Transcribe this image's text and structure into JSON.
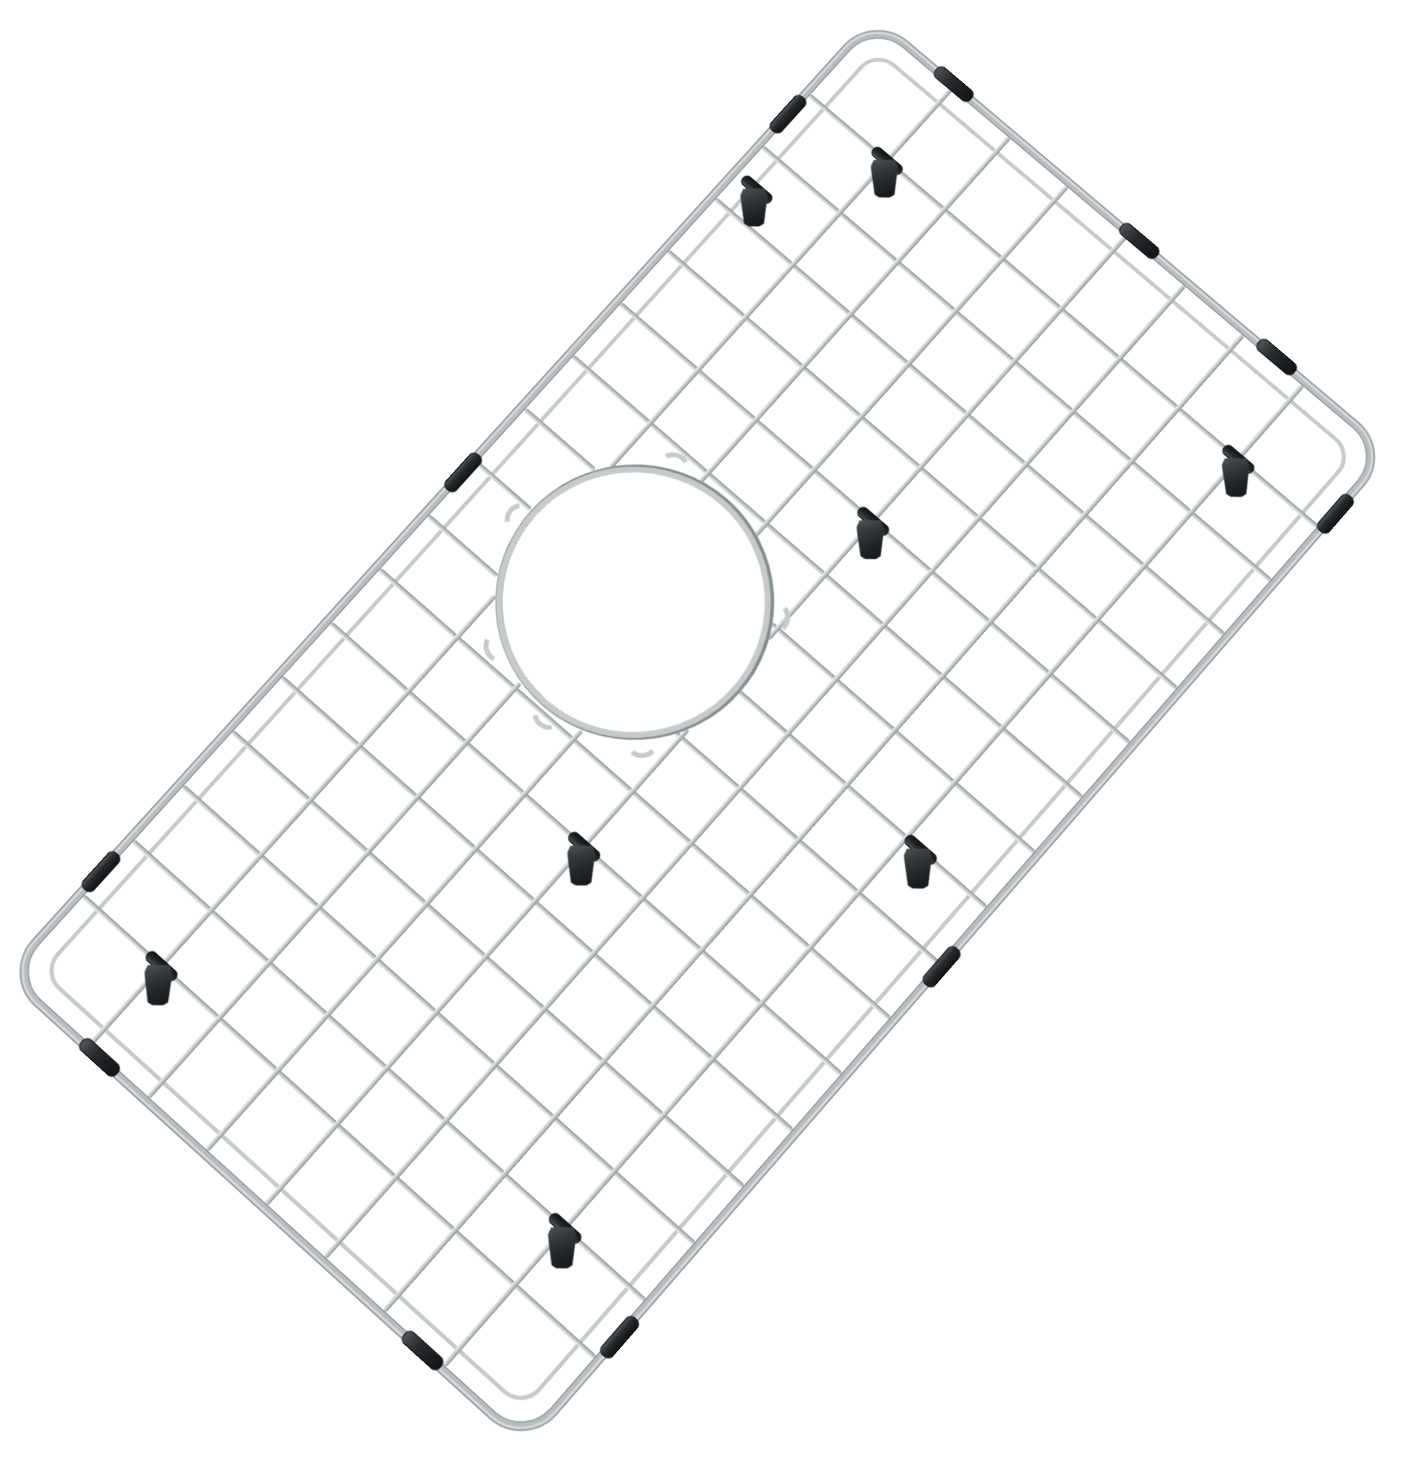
{
  "product": {
    "description": "stainless-steel-sink-bottom-grid-with-drain-hole",
    "background_color": "#ffffff"
  },
  "scene": {
    "canvas_w": 1405,
    "canvas_h": 1468,
    "plane_w": 1315,
    "plane_h": 695,
    "center_x": 704,
    "center_y": 710,
    "rotation_deg": -48.6,
    "tilt_deg": 7,
    "perspective_px": 3000
  },
  "colors": {
    "bg": "#ffffff",
    "wire_hi": "#f1f3f3",
    "wire_mid": "#c6cacb",
    "wire_dk": "#8e9597",
    "frame_hi": "#dfe3e4",
    "frame_mid": "#b7bdbf",
    "frame_dk": "#868d90",
    "rubber_hi": "#4d5357",
    "rubber_mid": "#26292d",
    "rubber_dk": "#121517"
  },
  "frame": {
    "thickness": 7,
    "corner_radius": 46
  },
  "inner_frame": {
    "inset": 26,
    "thickness": 4,
    "corner_radius": 26
  },
  "wires": {
    "thickness": 5,
    "span_pad": 8,
    "cross_x": [
      110,
      183,
      256,
      329,
      402,
      475,
      548,
      621,
      694,
      767,
      840,
      913,
      986,
      1059,
      1132,
      1205
    ],
    "long_y": [
      112,
      190,
      268,
      347,
      425,
      503,
      582
    ]
  },
  "drain_ring": {
    "cx": 693,
    "cy": 221,
    "r": 132,
    "thickness": 6,
    "clear_r": 140,
    "elbow_angles_deg": [
      -95,
      -150,
      175,
      135,
      -25,
      55
    ]
  },
  "bumpers": {
    "length": 46,
    "thickness": 13,
    "top_x": [
      139,
      677,
      1175
    ],
    "bottom_x": [
      140,
      620,
      1227
    ],
    "left_y": [
      127,
      556
    ],
    "right_y": [
      110,
      360,
      543
    ]
  },
  "feet": {
    "hook_w": 28,
    "hook_h": 40,
    "sleeve_w": 10,
    "sleeve_h": 36,
    "hang_rotation_deg": 48.6,
    "anchors": [
      {
        "x": 1205,
        "y": 112
      },
      {
        "x": 1094,
        "y": 32
      },
      {
        "x": 913,
        "y": 347
      },
      {
        "x": 475,
        "y": 347
      },
      {
        "x": 110,
        "y": 112
      },
      {
        "x": 183,
        "y": 582
      },
      {
        "x": 1205,
        "y": 582
      },
      {
        "x": 694,
        "y": 600
      }
    ]
  }
}
